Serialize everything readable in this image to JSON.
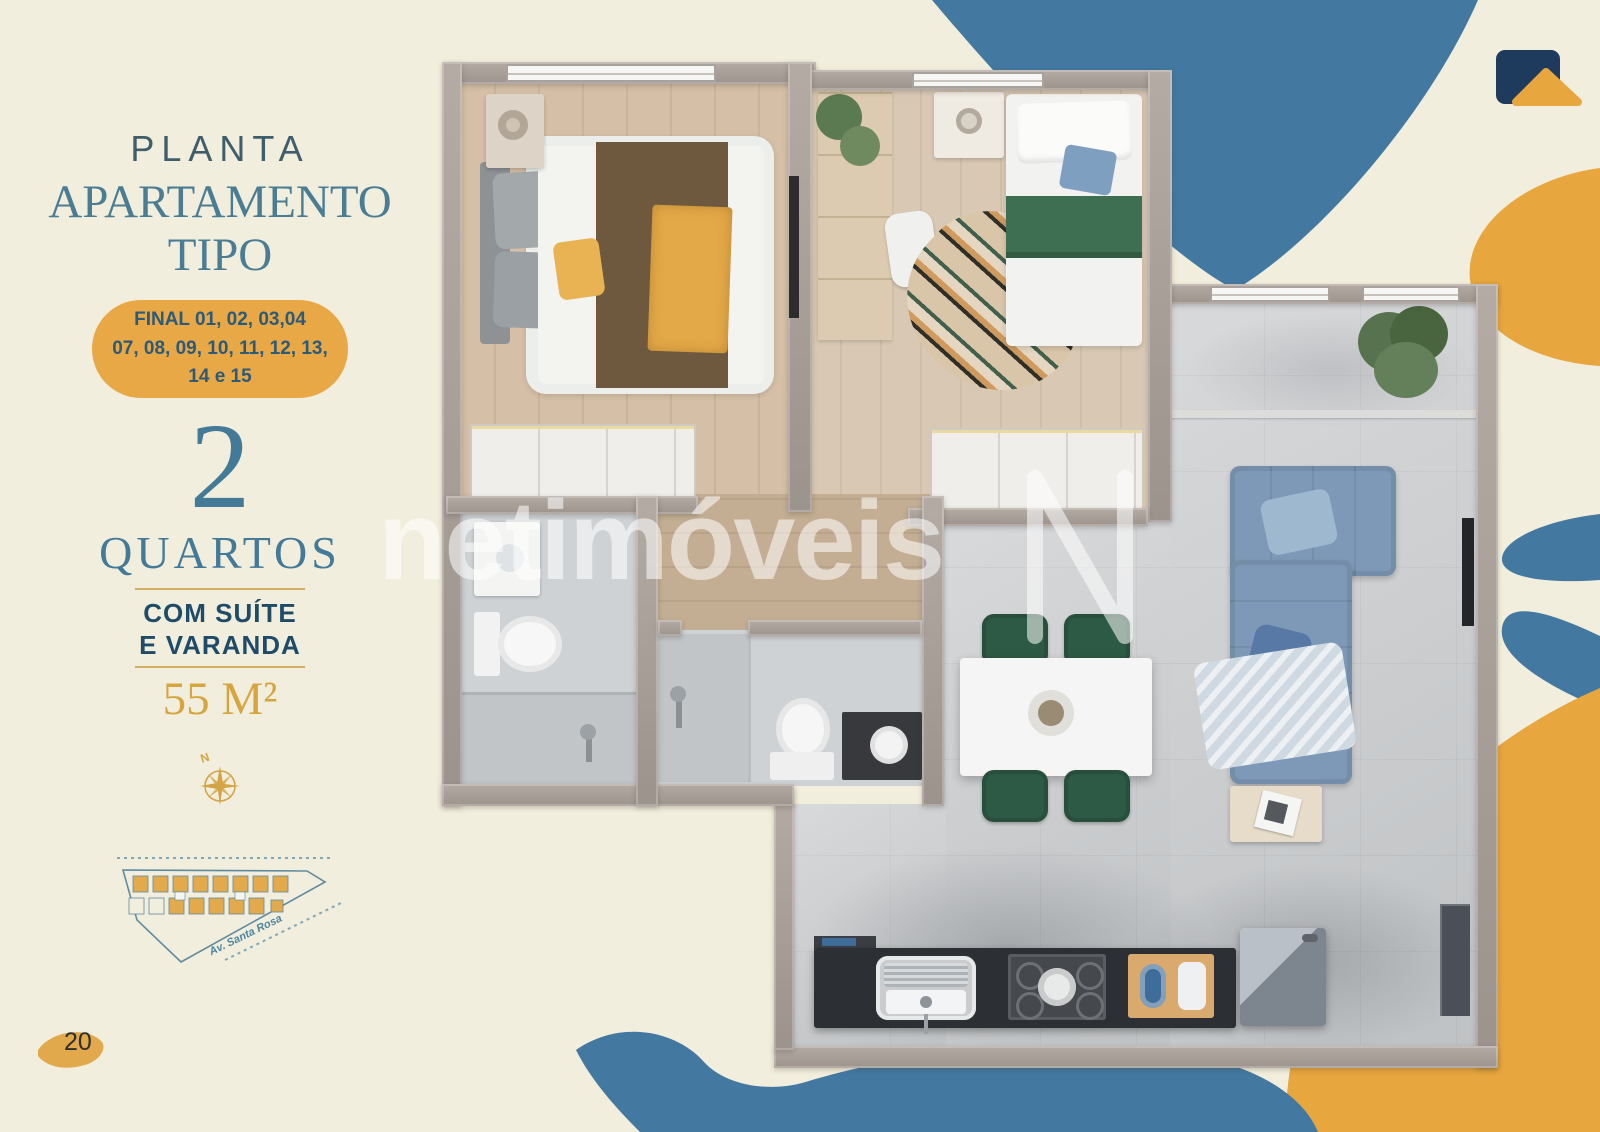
{
  "page": {
    "number": "20"
  },
  "panel": {
    "kicker": "PLANTA",
    "title_line1": "APARTAMENTO",
    "title_line2": "TIPO",
    "badge_lines": [
      "FINAL 01, 02, 03,04",
      "07, 08, 09, 10, 11, 12, 13,",
      "14 e 15"
    ],
    "rooms_count": "2",
    "rooms_label": "QUARTOS",
    "feature_line1": "COM SUÍTE",
    "feature_line2": "E VARANDA",
    "area": "55 M²",
    "compass_label": "N",
    "sitemap_street": "Av. Santa Rosa"
  },
  "watermark": {
    "text": "netimóveis"
  },
  "colors": {
    "background": "#f2eedd",
    "decor_blue": "#4379a1",
    "decor_gold": "#e7a63e",
    "logo_navy": "#1e3a5c",
    "heading_teal": "#4a7d94",
    "kicker_slate": "#3f5d6b",
    "badge_gold": "#e7a845",
    "badge_text": "#2c5a7a",
    "feature_text": "#1e4b68",
    "area_gold": "#d6a53e"
  }
}
